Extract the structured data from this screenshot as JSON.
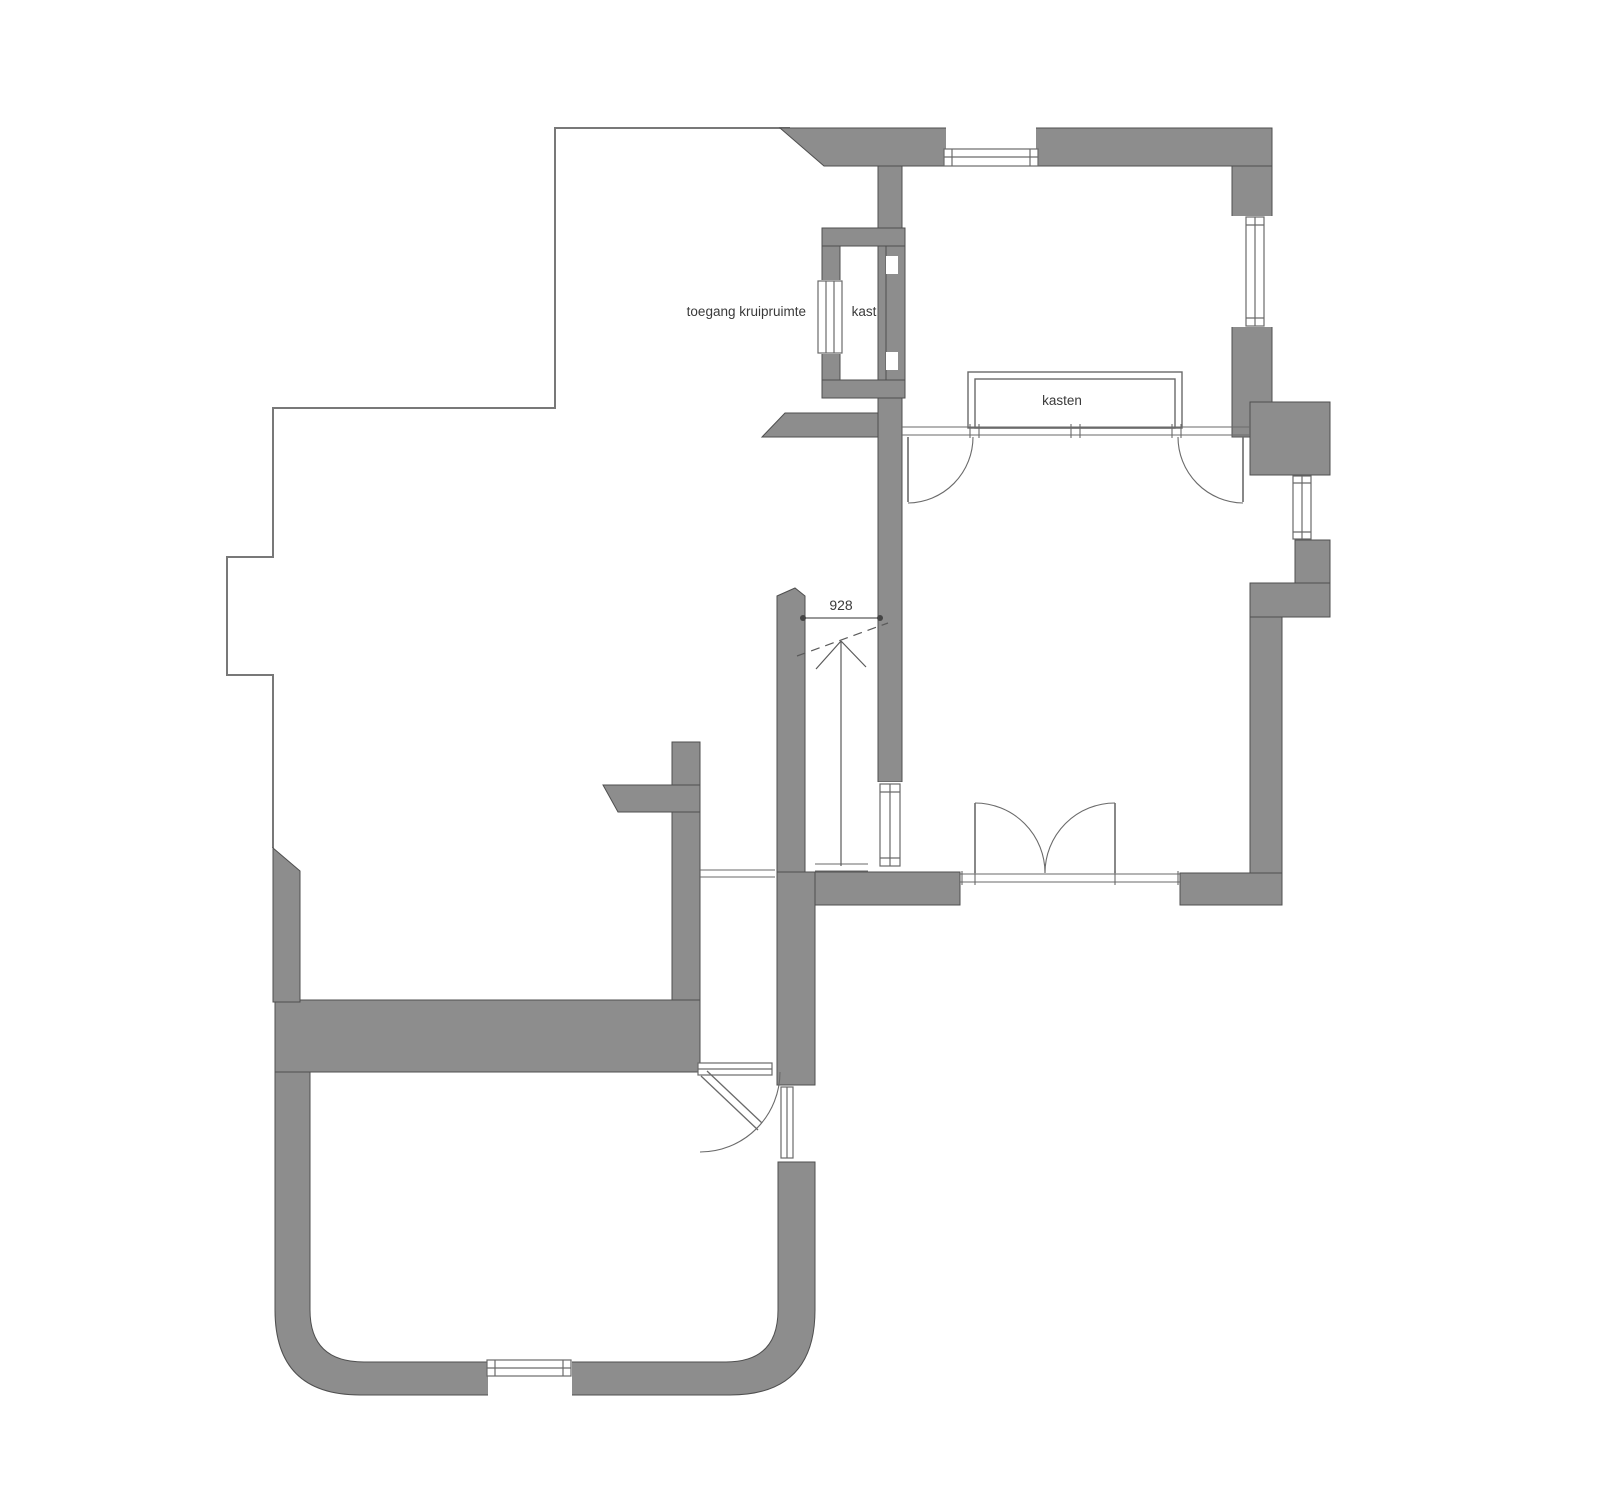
{
  "plan": {
    "type": "floor-plan",
    "labels": {
      "crawlspace_access": "toegang kruipruimte",
      "closet": "kast",
      "closets": "kasten",
      "stair_width_dimension": "928"
    },
    "colors": {
      "background": "#ffffff",
      "wall_fill": "#8d8d8d",
      "wall_outline": "#4f4f4f",
      "thin_line": "#787878",
      "frame_line": "#6a6a6a",
      "text": "#3a3a3a"
    }
  }
}
